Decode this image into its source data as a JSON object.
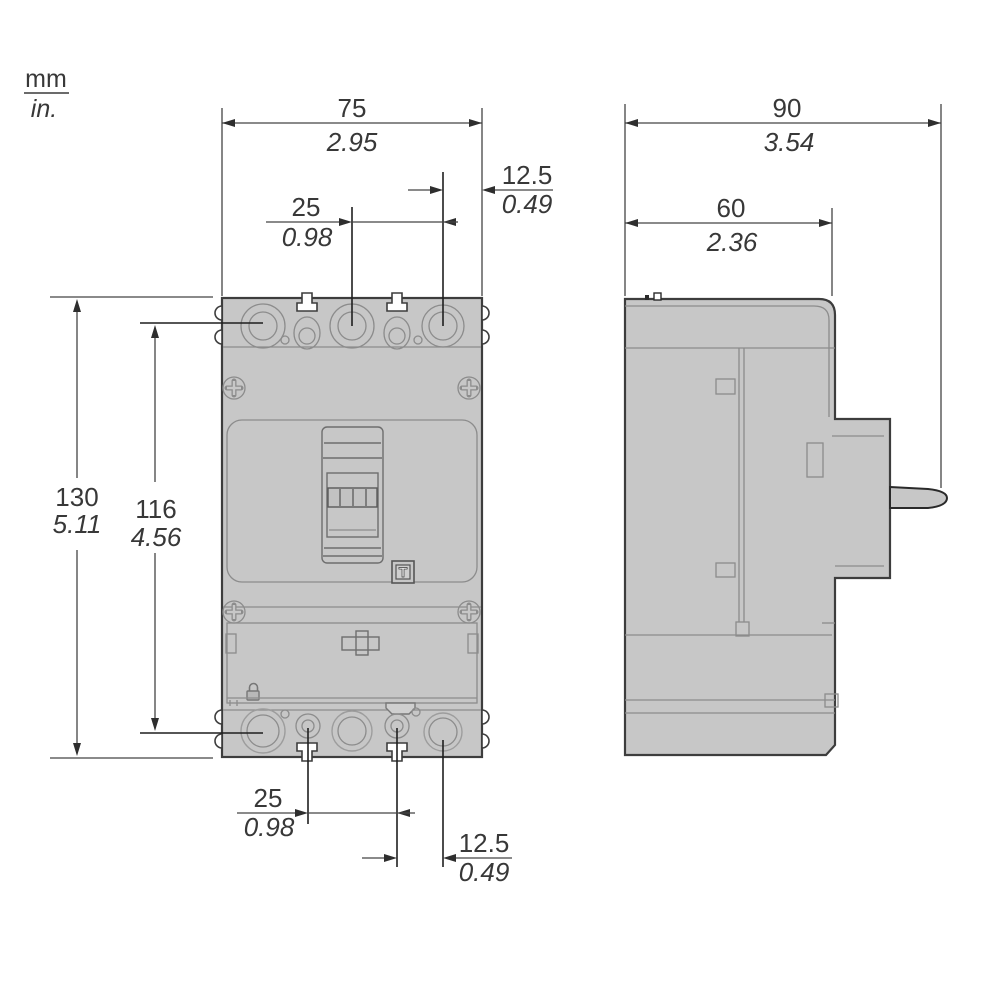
{
  "units_legend": {
    "primary": "mm",
    "secondary": "in."
  },
  "front_view": {
    "trip_button_label": "T",
    "dims": {
      "width": {
        "mm": "75",
        "in": "2.95"
      },
      "pole_pitch_top": {
        "mm": "25",
        "in": "0.98"
      },
      "edge_offset_top": {
        "mm": "12.5",
        "in": "0.49"
      },
      "height": {
        "mm": "130",
        "in": "5.11"
      },
      "terminal_span": {
        "mm": "116",
        "in": "4.56"
      },
      "pole_pitch_bottom": {
        "mm": "25",
        "in": "0.98"
      },
      "edge_offset_bottom": {
        "mm": "12.5",
        "in": "0.49"
      }
    }
  },
  "side_view": {
    "dims": {
      "depth": {
        "mm": "90",
        "in": "3.54"
      },
      "body_depth": {
        "mm": "60",
        "in": "2.36"
      }
    }
  },
  "colors": {
    "body_fill": "#c7c7c7",
    "outline": "#3d3d3d",
    "detail_line": "#8c8c8c",
    "dimension_line": "#454545",
    "text": "#383838",
    "background": "#ffffff"
  }
}
